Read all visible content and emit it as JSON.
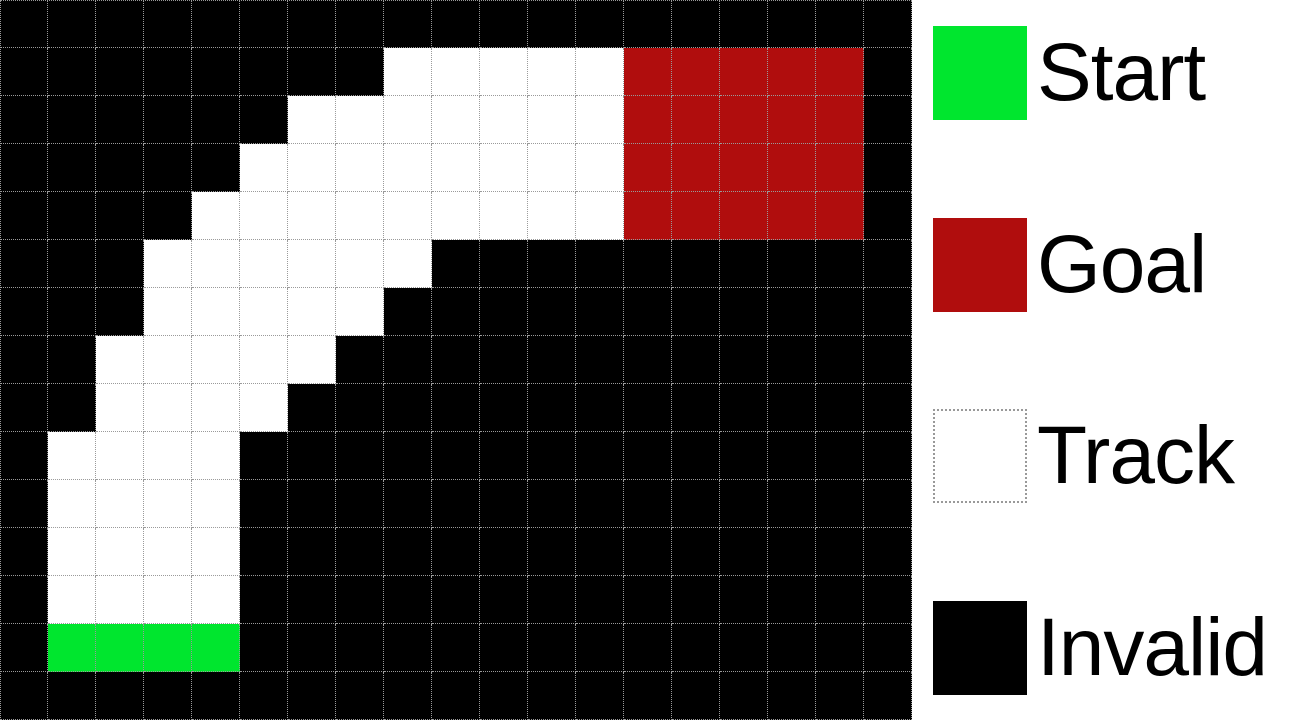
{
  "figure": {
    "type": "racetrack-gridworld"
  },
  "grid": {
    "rows": 15,
    "cols": 19,
    "cell_size_px": 48,
    "cell_codes": {
      ".": "invalid",
      "T": "track",
      "S": "start",
      "G": "goal"
    },
    "rows_map": [
      "...................",
      "........TTTTTGGGGG.",
      "......TTTTTTTGGGGG.",
      ".....TTTTTTTTGGGGG.",
      "....TTTTTTTTTGGGGG.",
      "...TTTTTT..........",
      "...TTTTT...........",
      "..TTTTT............",
      "..TTTT.............",
      ".TTTT..............",
      ".TTTT..............",
      ".TTTT..............",
      ".TTTT..............",
      ".SSSS..............",
      "..................."
    ],
    "colors": {
      "invalid": "#000000",
      "track": "#ffffff",
      "start": "#00e62e",
      "goal": "#b00d0d",
      "gridline": "#9a9a9a"
    }
  },
  "legend": {
    "background": "#ffffff",
    "items": [
      {
        "id": "start",
        "label": "Start",
        "color": "#00e62e",
        "border": "none"
      },
      {
        "id": "goal",
        "label": "Goal",
        "color": "#b00d0d",
        "border": "none"
      },
      {
        "id": "track",
        "label": "Track",
        "color": "#ffffff",
        "border": "dotted"
      },
      {
        "id": "invalid",
        "label": "Invalid",
        "color": "#000000",
        "border": "none"
      }
    ]
  }
}
